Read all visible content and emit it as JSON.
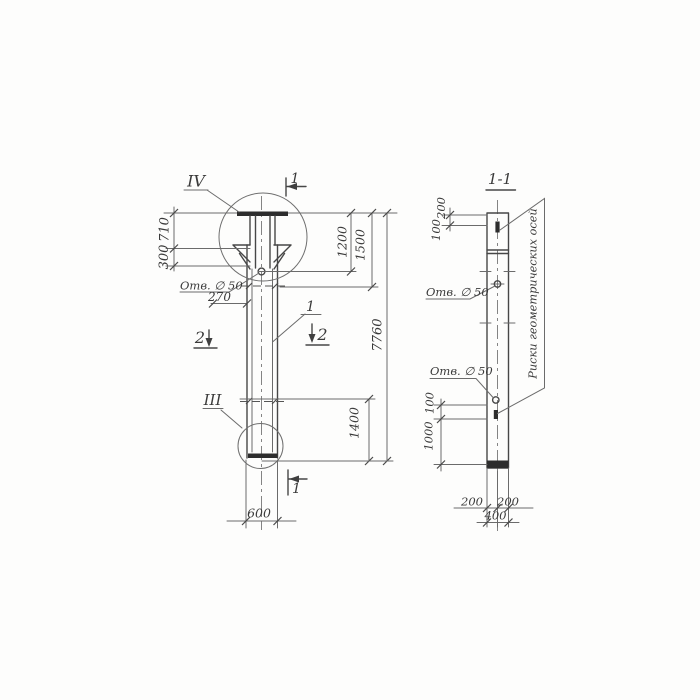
{
  "drawing": {
    "left_view": {
      "detail_top_label": "IV",
      "detail_bottom_label": "III",
      "section_top_label": "1",
      "section_bottom_label": "1",
      "section_left_label": "2",
      "section_right_label": "2",
      "part_leader_label": "1",
      "hole_label": "Отв. ∅ 50",
      "dim_710": "710",
      "dim_300": "300",
      "dim_270": "270",
      "dim_1200": "1200",
      "dim_1500": "1500",
      "dim_7760": "7760",
      "dim_1400": "1400",
      "dim_600": "600"
    },
    "section_view": {
      "title": "1-1",
      "dim_200_top": "200",
      "dim_100_top": "100",
      "hole_label_top": "Отв. ∅ 50",
      "hole_label_bottom": "Отв. ∅ 50",
      "dim_100_mid": "100",
      "dim_1000": "1000",
      "dim_200_bottom_left": "200",
      "dim_200_bottom_right": "200",
      "dim_400": "400",
      "axes_note": "Риски геометрических осей"
    }
  }
}
